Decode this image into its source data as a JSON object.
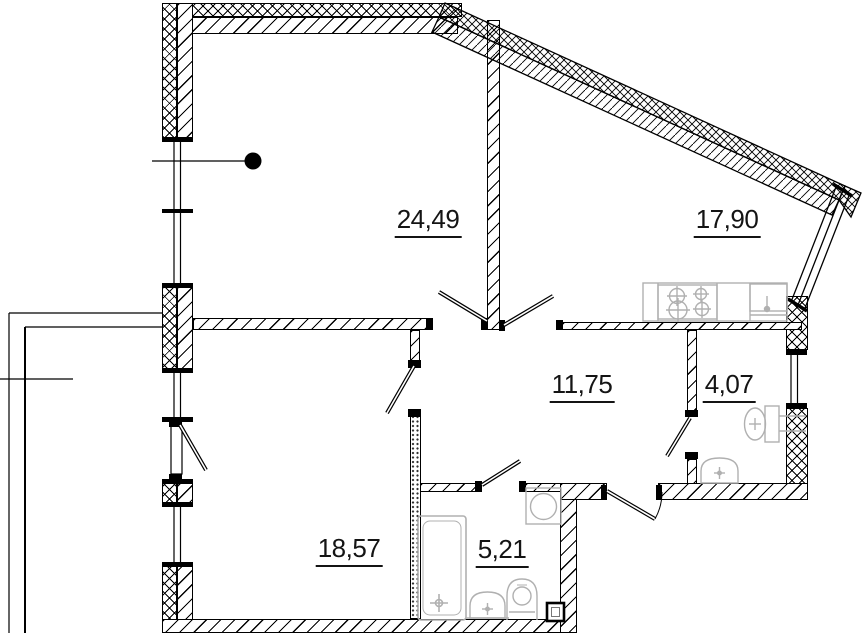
{
  "plan": {
    "rooms": [
      {
        "id": "room-24-49",
        "area": "24,49"
      },
      {
        "id": "kitchen-17-90",
        "area": "17,90"
      },
      {
        "id": "hallway-11-75",
        "area": "11,75"
      },
      {
        "id": "bath-4-07",
        "area": "4,07"
      },
      {
        "id": "room-18-57",
        "area": "18,57"
      },
      {
        "id": "bath-5-21",
        "area": "5,21"
      }
    ],
    "icons": [
      "stove-icon",
      "kitchen-sink-icon",
      "toilet-icon",
      "washbasin-icon",
      "bathtub-icon",
      "washing-machine-icon",
      "vent-box-icon",
      "reference-dot-icon",
      "door-swing-icon",
      "window-icon",
      "balcony-icon"
    ],
    "colors": {
      "line": "#000000",
      "fixture": "#b0b0b0",
      "background": "#ffffff"
    }
  }
}
